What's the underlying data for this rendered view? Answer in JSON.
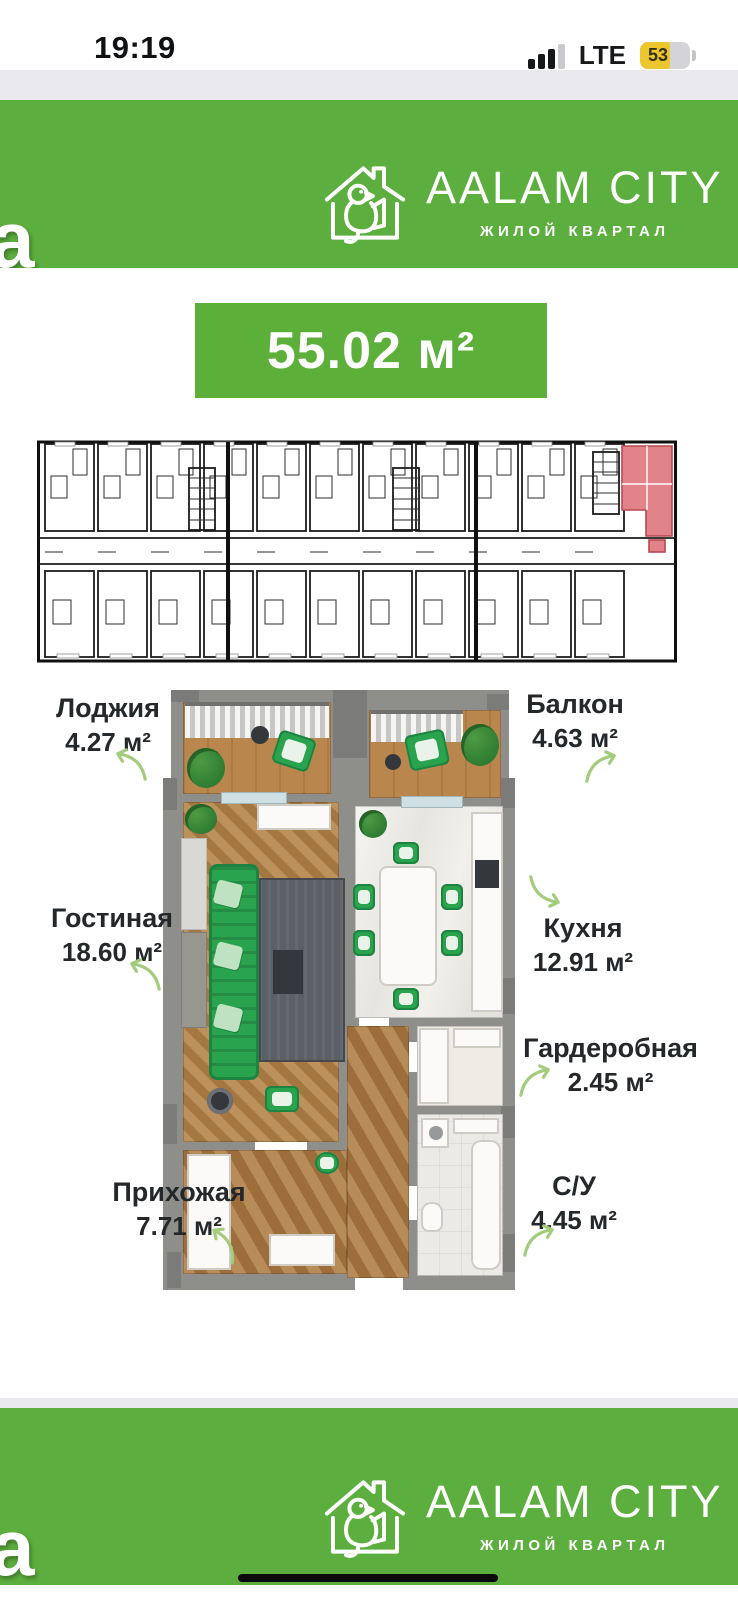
{
  "status_bar": {
    "time": "19:19",
    "network": "LTE",
    "battery": "53"
  },
  "brand": {
    "name": "AALAM CITY",
    "tagline": "ЖИЛОЙ КВАРТАЛ",
    "watermark_letter": "a"
  },
  "apartment": {
    "total_area": "55.02 м²"
  },
  "rooms": [
    {
      "label": "Лоджия",
      "area": "4.27 м²"
    },
    {
      "label": "Балкон",
      "area": "4.63 м²"
    },
    {
      "label": "Гостиная",
      "area": "18.60 м²"
    },
    {
      "label": "Кухня",
      "area": "12.91 м²"
    },
    {
      "label": "Гардеробная",
      "area": "2.45 м²"
    },
    {
      "label": "Прихожая",
      "area": "7.71 м²"
    },
    {
      "label": "С/У",
      "area": "4.45 м²"
    }
  ],
  "colors": {
    "brand_green": "#5CAF3E",
    "arrow_green": "#A3CD7C",
    "highlight_red": "#E2838A"
  }
}
